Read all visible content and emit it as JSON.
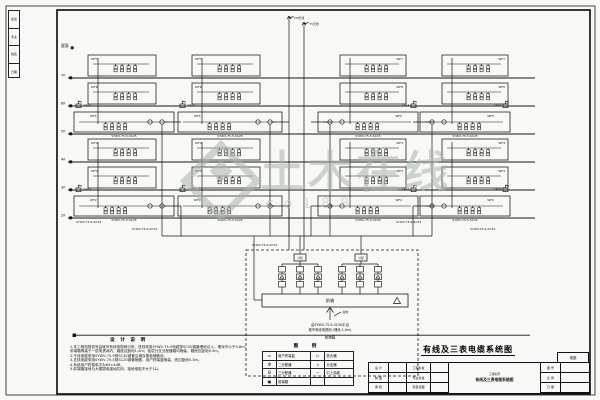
{
  "watermark": {
    "text": "土木在线",
    "subtext": "co188"
  },
  "sheet": {
    "title": "有线及三表电缆系统图"
  },
  "floors": {
    "top_label": "屋面",
    "labels": [
      "7F",
      "6F",
      "5F",
      "4F",
      "3F",
      "2F"
    ]
  },
  "rows_labels": [
    "WF7",
    "WF6",
    "WF5",
    "WF4",
    "WF3",
    "WF2"
  ],
  "labels": {
    "amp": "230A",
    "branch_cable": "SYWV-75-5-SC25",
    "riser_cable": "SYWV-75-9-SC32",
    "antenna1": "FM天线",
    "antenna2": "TV天线"
  },
  "headend": {
    "splitter": "分配",
    "unit": "前端",
    "feed_note1": "由SYWV-75-9-SC50引自",
    "feed_note2": "城市有线电视网 (埋深-1.0m)",
    "ground": "接地",
    "box_name": "前端箱"
  },
  "notes": {
    "heading": "设 计 说 明",
    "lines": [
      "1.本工程电视信号由城市有线电视网引来，进线采用SYWV-75-9电缆穿SC50钢管埋地引入，埋深不小于0.8m。",
      "  前端箱明装于一层电表间内，箱底边距地1.4m；各层分支分配器箱均暗装，箱底边距地0.5m。",
      "2.干线电缆采用SYWV-75-9穿SC32钢管沿墙及楼板暗敷设。",
      "3.支线电缆采用SYWV-75-5穿SC20钢管暗敷，用户终端盒暗装，底边距地0.3m。",
      "4.系统用户终端电平为64±4dB。",
      "5.前端箱接地与大楼弱电接地共用，接地电阻不大于1Ω。"
    ]
  },
  "legend": {
    "heading": "图 例",
    "rows": [
      {
        "s1": "▭",
        "n1": "用户终端盒",
        "s2": "▷",
        "n2": "放大器"
      },
      {
        "s1": "Φ",
        "n1": "二分配器",
        "s2": "┬",
        "n2": "分支器"
      },
      {
        "s1": "Θ",
        "n1": "三分配器",
        "s2": "⌐",
        "n2": "引上电缆"
      },
      {
        "s1": "▣",
        "n1": "前端箱",
        "s2": "",
        "n2": ""
      }
    ]
  },
  "titleblock": {
    "rows_left": [
      {
        "k": "设 计"
      },
      {
        "k": "制 图"
      },
      {
        "k": "审 核"
      }
    ],
    "rows_mid": [
      {
        "k": "工程负责"
      },
      {
        "k": "专业负责"
      },
      {
        "k": "项目经理"
      }
    ],
    "project_label": "工程名称",
    "drawing_name": "有线及三表电缆系统图",
    "no_label": "图 号",
    "scale_label": "比 例",
    "date_label": "日 期",
    "stage": "电施"
  },
  "sign_strip": {
    "groups": [
      "会签",
      "专业",
      "姓名",
      "日期"
    ]
  },
  "diagram_layout": {
    "floor_x": [
      68,
      535
    ],
    "floor_ys": [
      78,
      106,
      134,
      162,
      190,
      218
    ],
    "top_tick_y": 48,
    "columns": [
      {
        "nx": 88,
        "nw": 68,
        "wx": 74,
        "ww": 100
      },
      {
        "nx": 192,
        "nw": 68,
        "wx": 178,
        "ww": 104
      },
      {
        "nx": 340,
        "nw": 66,
        "wx": 318,
        "ww": 100
      },
      {
        "nx": 442,
        "nw": 66,
        "wx": 420,
        "ww": 90
      }
    ],
    "rows": [
      {
        "y": 55,
        "h": 21,
        "t": "n"
      },
      {
        "y": 83,
        "h": 21,
        "t": "n"
      },
      {
        "y": 112,
        "h": 20,
        "t": "w"
      },
      {
        "y": 139,
        "h": 21,
        "t": "n"
      },
      {
        "y": 167,
        "h": 21,
        "t": "n"
      },
      {
        "y": 196,
        "h": 20,
        "t": "w"
      }
    ],
    "collector_y": 236,
    "dashed": [
      246,
      250,
      172,
      126
    ],
    "antenna_x": [
      289,
      304
    ],
    "cable_label_pos": [
      [
        76,
        223
      ],
      [
        132,
        230
      ],
      [
        252,
        246
      ],
      [
        396,
        223
      ],
      [
        470,
        230
      ]
    ]
  }
}
